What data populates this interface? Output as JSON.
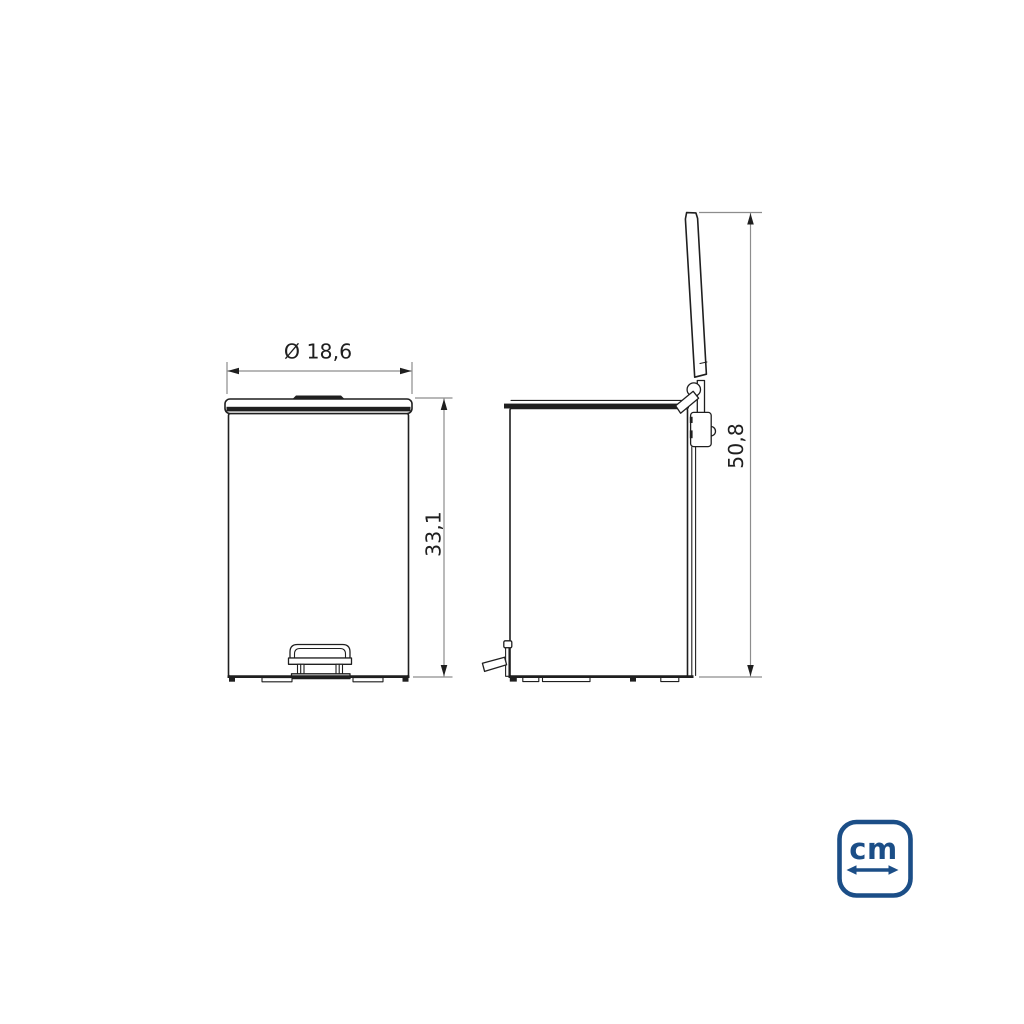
{
  "dimensions": {
    "front_width_label": "Ø 18,6",
    "front_height_label": "33,1",
    "side_height_label": "50,8"
  },
  "unit_badge": {
    "label": "cm",
    "icon": "horizontal-double-arrow-icon"
  },
  "colors": {
    "line": "#1f1f1f",
    "dimension_line": "#8d8d8d",
    "accent_blue": "#1b4e87",
    "background": "#ffffff"
  }
}
